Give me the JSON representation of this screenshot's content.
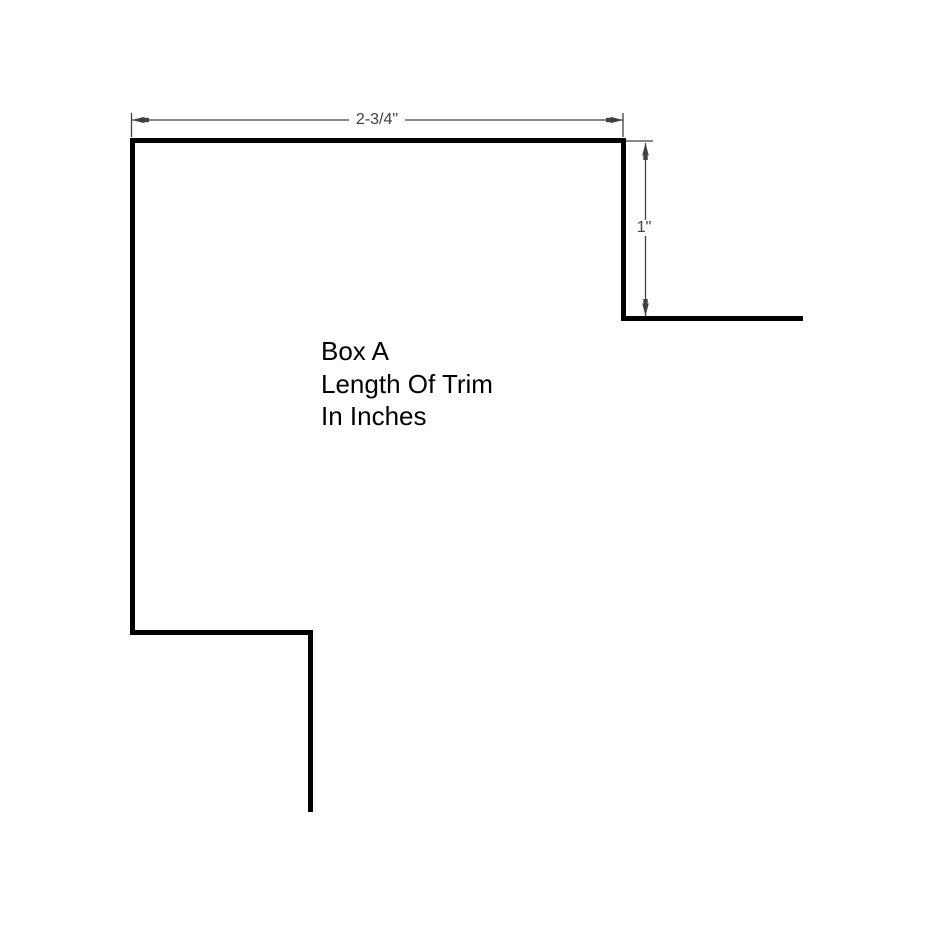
{
  "drawing": {
    "caption": {
      "line1": "Box A",
      "line2": "Length Of Trim",
      "line3": "In Inches"
    },
    "dimensions": {
      "width_label": "2-3/4\"",
      "height_label": "1\""
    },
    "colors": {
      "background": "#ffffff",
      "shape_line": "#000000",
      "dimension_line": "#404040",
      "dimension_text": "#404040",
      "caption_text": "#000000"
    }
  }
}
